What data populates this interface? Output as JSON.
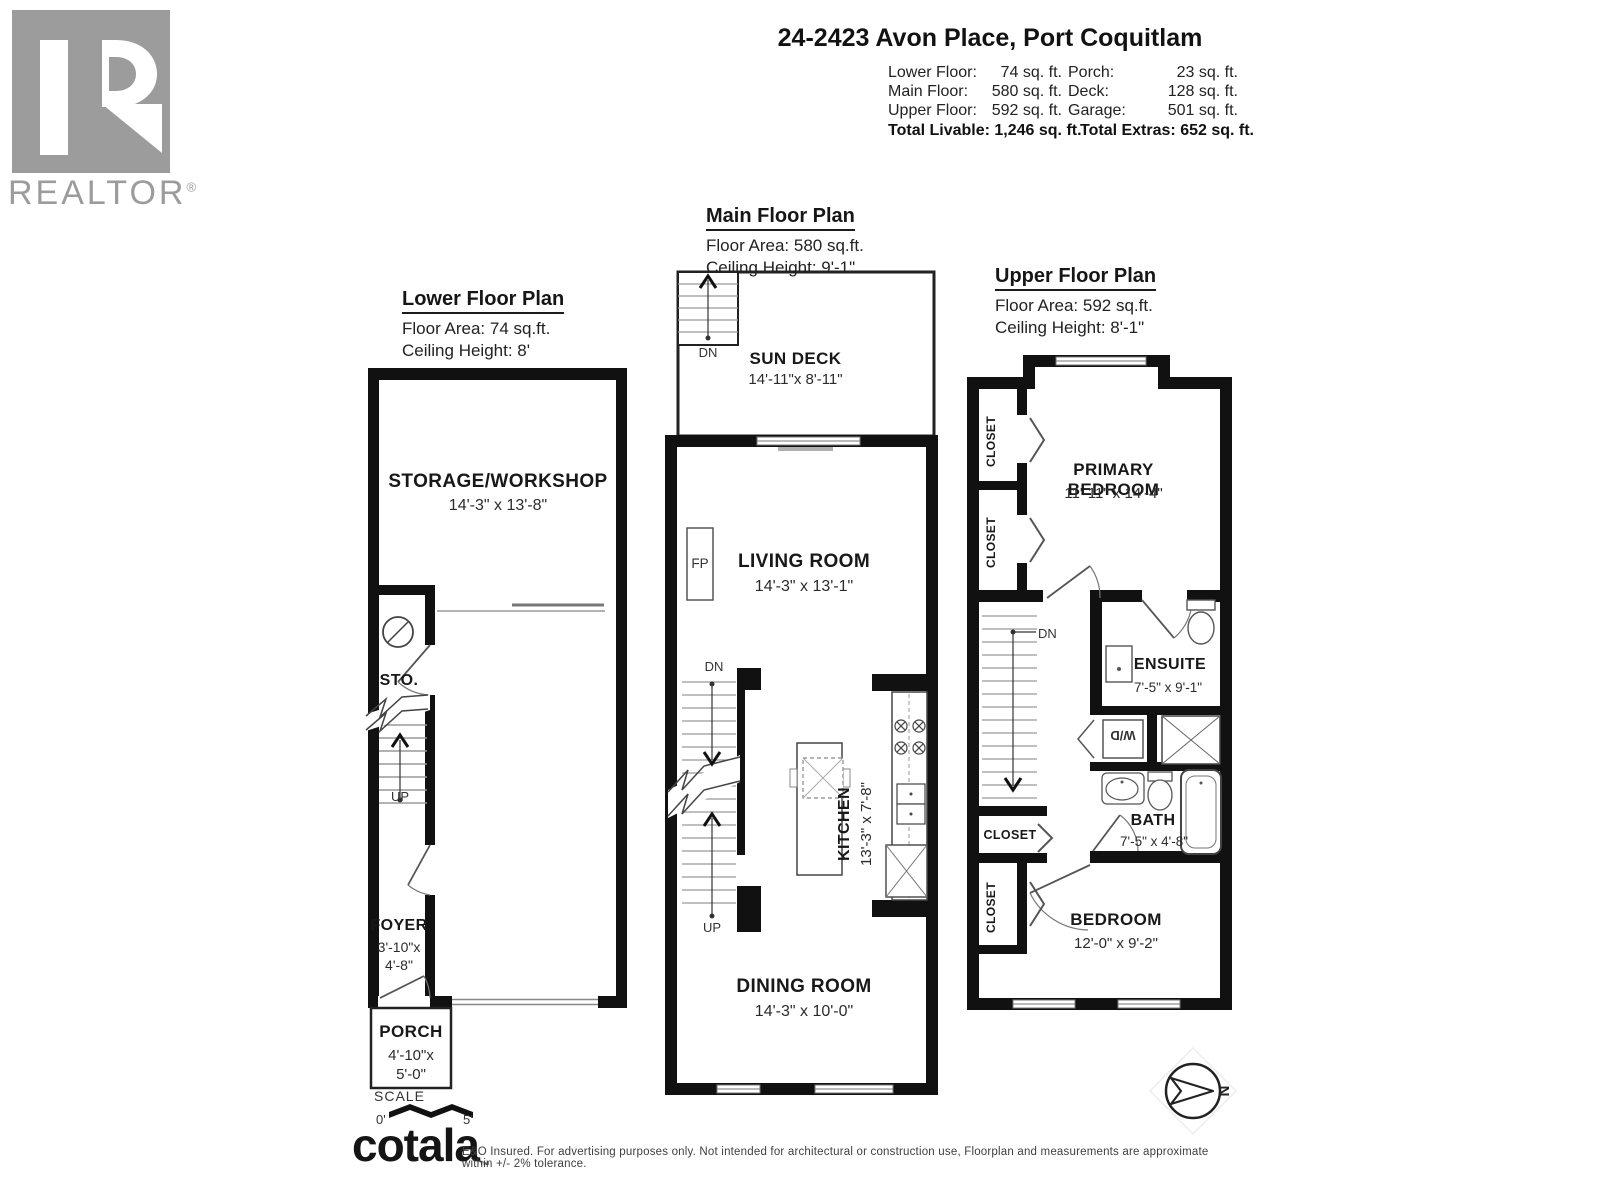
{
  "header": {
    "realtor": {
      "label": "REALTOR",
      "reg": "®"
    },
    "title": "24-2423 Avon Place, Port Coquitlam",
    "stats": {
      "left": [
        {
          "label": "Lower Floor:",
          "value": "74 sq. ft."
        },
        {
          "label": "Main Floor:",
          "value": "580 sq. ft."
        },
        {
          "label": "Upper Floor:",
          "value": "592 sq. ft."
        }
      ],
      "right": [
        {
          "label": "Porch:",
          "value": "23 sq. ft."
        },
        {
          "label": "Deck:",
          "value": "128 sq. ft."
        },
        {
          "label": "Garage:",
          "value": "501 sq. ft."
        }
      ],
      "total_livable": {
        "label": "Total Livable:",
        "value": "1,246 sq. ft."
      },
      "total_extras": {
        "label": "Total Extras:",
        "value": "652 sq. ft."
      }
    }
  },
  "plans": {
    "lower": {
      "title": "Lower Floor Plan",
      "area": "Floor Area: 74 sq.ft.",
      "ceiling": "Ceiling Height: 8'"
    },
    "main": {
      "title": "Main Floor Plan",
      "area": "Floor Area: 580 sq.ft.",
      "ceiling": "Ceiling Height: 9'-1\""
    },
    "upper": {
      "title": "Upper Floor Plan",
      "area": "Floor Area: 592 sq.ft.",
      "ceiling": "Ceiling Height: 8'-1\""
    }
  },
  "rooms": {
    "storage": {
      "name": "STORAGE/WORKSHOP",
      "dims": "14'-3\" x 13'-8\""
    },
    "sto": {
      "name": "STO."
    },
    "foyer": {
      "name": "FOYER",
      "dims1": "3'-10\"x",
      "dims2": "4'-8\""
    },
    "porch": {
      "name": "PORCH",
      "dims1": "4'-10\"x",
      "dims2": "5'-0\""
    },
    "sundeck": {
      "name": "SUN DECK",
      "dims": "14'-11\"x 8'-11\""
    },
    "living": {
      "name": "LIVING ROOM",
      "dims": "14'-3\" x 13'-1\""
    },
    "kitchen": {
      "name": "KITCHEN",
      "dims": "13'-3\" x 7'-8\""
    },
    "dining": {
      "name": "DINING ROOM",
      "dims": "14'-3\" x 10'-0\""
    },
    "primary": {
      "name": "PRIMARY BEDROOM",
      "dims": "11'-11\" x 14'-4\""
    },
    "ensuite": {
      "name": "ENSUITE",
      "dims": "7'-5\" x 9'-1\""
    },
    "bath": {
      "name": "BATH",
      "dims": "7'-5\" x 4'-8\""
    },
    "bedroom": {
      "name": "BEDROOM",
      "dims": "12'-0\" x 9'-2\""
    },
    "closet": "CLOSET",
    "wd": "W/D",
    "fp": "FP"
  },
  "labels": {
    "up": "UP",
    "dn": "DN",
    "scale": "SCALE",
    "scale_zero": "0'",
    "scale_five": "5'",
    "north": "N"
  },
  "footer": {
    "brand": "cotala",
    "tm": "™",
    "disclaimer": "E&O Insured. For advertising purposes only. Not intended for architectural or construction use, Floorplan and measurements are approximate within +/- 2% tolerance."
  },
  "colors": {
    "wall": "#111111",
    "logo_gray": "#9c9c9c"
  }
}
